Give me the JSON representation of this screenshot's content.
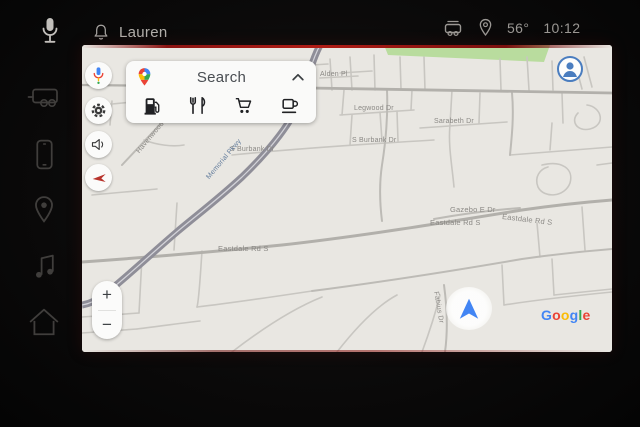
{
  "colors": {
    "accent_blue": "#4285F4",
    "google_red": "#EA4335",
    "google_yellow": "#FBBC05",
    "google_green": "#34A853",
    "screen_edge_red": "#a51a12",
    "map_background": "#e9e7e2",
    "park_green": "#b9dc9e"
  },
  "status_bar": {
    "user_name": "Lauren",
    "temperature": "56°",
    "time": "10:12"
  },
  "icons": {
    "status_left": [
      "voice-mic-icon",
      "notifications-bell-icon"
    ],
    "status_right": [
      "vehicle-status-icon",
      "location-pin-icon"
    ],
    "dock": [
      "trailer-vehicle-icon",
      "phone-icon",
      "navigation-pin-icon",
      "media-note-icon",
      "home-icon"
    ],
    "map_rail": [
      "assistant-mic-icon",
      "settings-gear-icon",
      "volume-icon",
      "back-arrow-icon"
    ],
    "search_categories": [
      "gas-station-icon",
      "restaurants-icon",
      "shopping-cart-icon",
      "coffee-icon"
    ],
    "search_bar": [
      "google-maps-pin-icon",
      "chevron-up-icon"
    ],
    "map_overlays": [
      "profile-avatar-icon",
      "navigation-arrow-icon"
    ]
  },
  "map_app": {
    "search_label": "Search",
    "zoom_in": "+",
    "zoom_out": "−",
    "google_logo": [
      "G",
      "o",
      "o",
      "g",
      "l",
      "e"
    ],
    "road_labels": [
      {
        "text": "Alden Pl"
      },
      {
        "text": "Legwood Dr"
      },
      {
        "text": "Sarabeth Dr"
      },
      {
        "text": "S Burbank Dr"
      },
      {
        "text": "S Burbank Dr"
      },
      {
        "text": "Havenwood Dr"
      },
      {
        "text": "Memorial Pkwy"
      },
      {
        "text": "Gazebo E Dr"
      },
      {
        "text": "Eastdale Rd S"
      },
      {
        "text": "Eastdale Rd S"
      },
      {
        "text": "Eastdale Rd S"
      },
      {
        "text": "Fabius Dr"
      }
    ]
  }
}
